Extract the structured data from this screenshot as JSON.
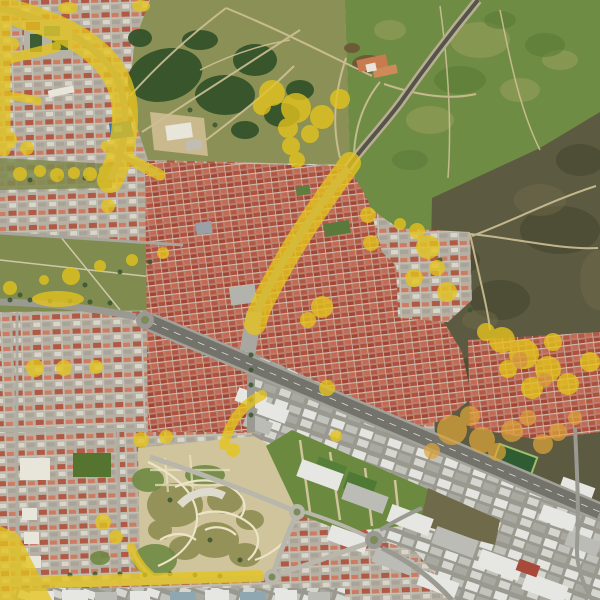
{
  "scene": {
    "kind": "satellite-aerial-imagery",
    "overlay_present": "yellow-highlight-annotation-layer"
  },
  "palette": {
    "base_urban": "#aaa396",
    "overlay_yellow": "#e5c41d",
    "overlay_orange": "#dfa63a",
    "field_green": "#6f8c44",
    "field_light": "#9aa05e",
    "field_dark": "#5a7c38",
    "scrub": "#5c5a40",
    "scrub_dark": "#45452f",
    "scrub_light": "#6e6a4a",
    "park_olive": "#8b9156",
    "forest": "#315029",
    "brown_trees": "#6b4f33",
    "grass_strip": "#7f8b4f",
    "lawn": "#6b8a3f",
    "park_tan": "#cfc49b",
    "cell_olive": "#8f8d52",
    "cell_green": "#6f8a44",
    "road_minor": "#b9b7ab",
    "road_mid": "#9a9a92",
    "highway": "#73736c",
    "shoulder": "#a3a29a",
    "lane": "#ffffff",
    "dirt": "#cfc096",
    "path_light": "#ece4c6",
    "tree_dot": "#3a5530",
    "sand": "#c9b98c",
    "white_bldg": "#e8e5da",
    "gray_bldg": "#c0beb4",
    "teal_court": "#3f7d7d",
    "court_green": "#3c5c33",
    "blue_roof": "#3e6fa3",
    "pool_blue": "#54b0c0",
    "pitch": "#2f5c33",
    "pitch_line": "#9fbf6a",
    "warehouse_white": "#e6e6e2",
    "warehouse_gray": "#bcbcb6",
    "red_roof": "#a84a3a",
    "blue_gray_roof": "#8fa7b0",
    "median_green": "#7d8a5a",
    "dark_road": "#55544a"
  },
  "overlay": {
    "yellow_blobs": [
      [
        272,
        93,
        13
      ],
      [
        296,
        108,
        15
      ],
      [
        322,
        117,
        12
      ],
      [
        340,
        99,
        10
      ],
      [
        288,
        128,
        10
      ],
      [
        262,
        106,
        9
      ],
      [
        310,
        134,
        9
      ],
      [
        291,
        146,
        9
      ],
      [
        297,
        160,
        8
      ],
      [
        20,
        174,
        7
      ],
      [
        40,
        171,
        6
      ],
      [
        57,
        175,
        7
      ],
      [
        74,
        173,
        6
      ],
      [
        90,
        174,
        7
      ],
      [
        105,
        171,
        6
      ],
      [
        10,
        288,
        7
      ],
      [
        44,
        280,
        5
      ],
      [
        71,
        276,
        9
      ],
      [
        100,
        266,
        6
      ],
      [
        132,
        260,
        6
      ],
      [
        163,
        253,
        6
      ],
      [
        58,
        299,
        26,
        8
      ],
      [
        8,
        140,
        9
      ],
      [
        27,
        148,
        7
      ],
      [
        12,
        44,
        7
      ],
      [
        108,
        206,
        7
      ],
      [
        68,
        8,
        10,
        6
      ],
      [
        141,
        6,
        9,
        6
      ],
      [
        281,
        270,
        9
      ],
      [
        322,
        307,
        11
      ],
      [
        308,
        320,
        8
      ],
      [
        327,
        388,
        8
      ],
      [
        35,
        368,
        9
      ],
      [
        64,
        368,
        8
      ],
      [
        96,
        367,
        7
      ],
      [
        103,
        522,
        8
      ],
      [
        116,
        537,
        7
      ],
      [
        428,
        247,
        12
      ],
      [
        417,
        231,
        8
      ],
      [
        447,
        292,
        10
      ],
      [
        414,
        278,
        9
      ],
      [
        400,
        224,
        6
      ],
      [
        437,
        268,
        8
      ],
      [
        502,
        340,
        13
      ],
      [
        524,
        354,
        15
      ],
      [
        548,
        369,
        13
      ],
      [
        568,
        384,
        11
      ],
      [
        590,
        362,
        10
      ],
      [
        532,
        388,
        11
      ],
      [
        508,
        369,
        9
      ],
      [
        486,
        332,
        9
      ],
      [
        553,
        342,
        9
      ],
      [
        141,
        440,
        8
      ],
      [
        166,
        437,
        7
      ],
      [
        233,
        450,
        7
      ],
      [
        336,
        436,
        6
      ],
      [
        368,
        215,
        8
      ],
      [
        371,
        243,
        8
      ]
    ],
    "orange_blobs": [
      [
        452,
        430,
        15
      ],
      [
        482,
        440,
        13
      ],
      [
        512,
        431,
        11
      ],
      [
        543,
        444,
        10
      ],
      [
        470,
        416,
        10
      ],
      [
        432,
        451,
        8
      ],
      [
        497,
        452,
        9
      ],
      [
        528,
        418,
        8
      ],
      [
        558,
        432,
        9
      ],
      [
        575,
        418,
        7
      ],
      [
        520,
        360,
        8
      ],
      [
        545,
        380,
        7
      ]
    ],
    "tree_dots": [
      [
        30,
        180
      ],
      [
        60,
        178
      ],
      [
        85,
        178
      ],
      [
        20,
        295
      ],
      [
        85,
        285
      ],
      [
        120,
        272
      ],
      [
        150,
        262
      ],
      [
        70,
        575
      ],
      [
        95,
        574
      ],
      [
        120,
        574
      ],
      [
        145,
        575
      ],
      [
        170,
        574
      ],
      [
        195,
        575
      ],
      [
        220,
        576
      ],
      [
        251,
        355
      ],
      [
        251,
        370
      ],
      [
        251,
        385
      ],
      [
        251,
        400
      ],
      [
        251,
        415
      ],
      [
        440,
        260
      ],
      [
        470,
        310
      ],
      [
        170,
        500
      ],
      [
        210,
        540
      ],
      [
        240,
        560
      ],
      [
        10,
        300
      ],
      [
        30,
        300
      ],
      [
        50,
        301
      ],
      [
        70,
        301
      ],
      [
        90,
        302
      ],
      [
        110,
        303
      ],
      [
        165,
        90
      ],
      [
        190,
        110
      ],
      [
        215,
        125
      ],
      [
        240,
        130
      ]
    ]
  },
  "textures": {
    "field_mottles_light": [
      [
        480,
        40,
        30,
        18
      ],
      [
        430,
        120,
        24,
        14
      ],
      [
        520,
        90,
        20,
        12
      ],
      [
        390,
        30,
        16,
        10
      ],
      [
        560,
        60,
        18,
        10
      ]
    ],
    "field_mottles_dark": [
      [
        460,
        80,
        26,
        14
      ],
      [
        545,
        45,
        20,
        12
      ],
      [
        410,
        160,
        18,
        10
      ],
      [
        500,
        20,
        16,
        9
      ]
    ],
    "scrub_dark_patches": [
      [
        560,
        230,
        40,
        24
      ],
      [
        500,
        300,
        30,
        20
      ],
      [
        580,
        160,
        24,
        16
      ],
      [
        460,
        260,
        20,
        14
      ],
      [
        540,
        420,
        26,
        14
      ],
      [
        470,
        370,
        20,
        12
      ]
    ],
    "scrub_light_patches": [
      [
        540,
        200,
        26,
        16
      ],
      [
        598,
        280,
        18,
        30
      ],
      [
        480,
        320,
        18,
        10
      ]
    ],
    "forest_blobs": [
      [
        165,
        75,
        38,
        26,
        -15
      ],
      [
        225,
        95,
        30,
        20,
        0
      ],
      [
        255,
        60,
        22,
        16,
        0
      ],
      [
        282,
        115,
        18,
        12,
        0
      ],
      [
        200,
        40,
        18,
        10,
        0
      ],
      [
        300,
        90,
        14,
        10,
        0
      ],
      [
        140,
        38,
        12,
        9,
        0
      ],
      [
        245,
        130,
        14,
        9,
        0
      ]
    ],
    "brown_tree_patches": [
      [
        368,
        64,
        16,
        9,
        0
      ],
      [
        352,
        48,
        8,
        5,
        0
      ]
    ],
    "park_cells_olive": [
      [
        175,
        505,
        28,
        22
      ],
      [
        215,
        540,
        24,
        18
      ],
      [
        245,
        555,
        16,
        12
      ],
      [
        185,
        548,
        16,
        12
      ],
      [
        225,
        500,
        18,
        14
      ],
      [
        250,
        520,
        14,
        10
      ],
      [
        160,
        530,
        12,
        10
      ]
    ],
    "park_cells_green": [
      [
        155,
        560,
        22,
        16
      ],
      [
        148,
        480,
        16,
        12
      ],
      [
        205,
        475,
        20,
        10
      ],
      [
        100,
        558,
        10,
        7
      ]
    ]
  }
}
